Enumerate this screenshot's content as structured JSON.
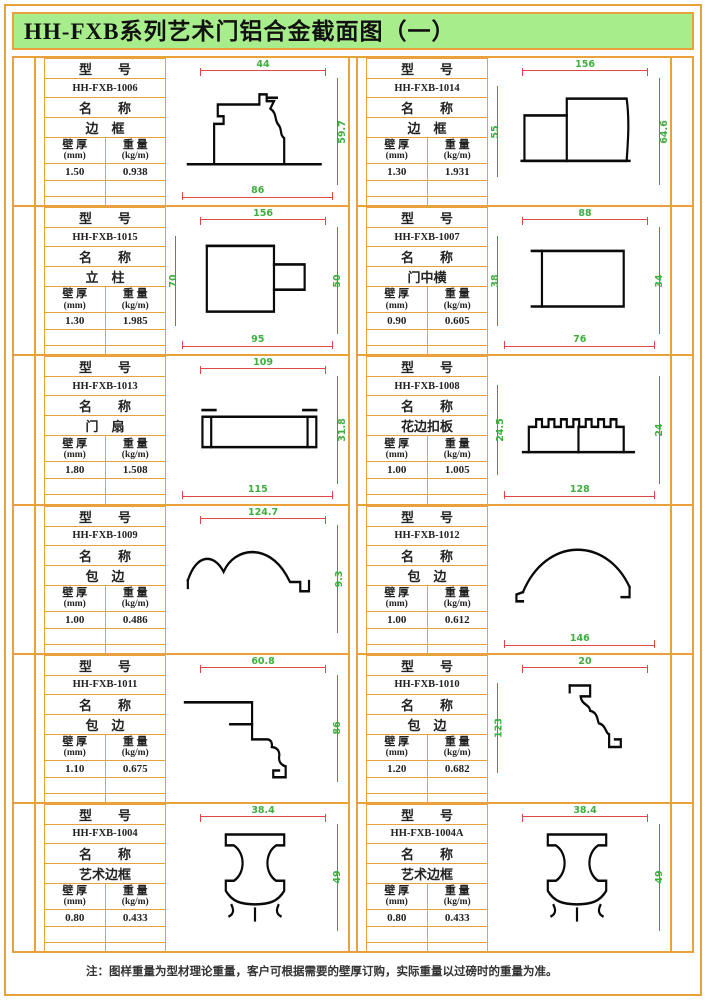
{
  "title": "HH-FXB系列艺术门铝合金截面图（一）",
  "footer_note": "注：图样重量为型材理论重量，客户可根据需要的壁厚订购，实际重量以过磅时的重量为准。",
  "colors": {
    "accent_orange": "#E8A13B",
    "header_green": "#A8ED8C",
    "dimension_line_red": "#E04848",
    "dimension_text_green": "#3FAE3F"
  },
  "labels": {
    "model": "型　　号",
    "name": "名　　称",
    "thickness_cn": "壁 厚",
    "thickness_unit": "(mm)",
    "weight_cn": "重 量",
    "weight_unit": "(kg/m)"
  },
  "panels": [
    {
      "model": "HH-FXB-1006",
      "name": "边　框",
      "thickness": "1.50",
      "weight": "0.938",
      "shape": "stepped-frame",
      "dims": {
        "top": "44",
        "right": "59.7",
        "bottom": "86"
      }
    },
    {
      "model": "HH-FXB-1014",
      "name": "边　框",
      "thickness": "1.30",
      "weight": "1.931",
      "shape": "double-box",
      "dims": {
        "top": "156",
        "left": "55",
        "right": "64.6"
      }
    },
    {
      "model": "HH-FXB-1015",
      "name": "立　柱",
      "thickness": "1.30",
      "weight": "1.985",
      "shape": "box-with-tab",
      "dims": {
        "top": "156",
        "left": "70",
        "right": "50",
        "bottom": "95"
      }
    },
    {
      "model": "HH-FXB-1007",
      "name": "门中横",
      "thickness": "0.90",
      "weight": "0.605",
      "shape": "hollow-box",
      "dims": {
        "top": "88",
        "left": "38",
        "right": "34",
        "bottom": "76"
      }
    },
    {
      "model": "HH-FXB-1013",
      "name": "门　扇",
      "thickness": "1.80",
      "weight": "1.508",
      "shape": "flat-panel",
      "dims": {
        "top": "109",
        "right": "31.8",
        "bottom": "115"
      }
    },
    {
      "model": "HH-FXB-1008",
      "name": "花边扣板",
      "thickness": "1.00",
      "weight": "1.005",
      "shape": "serrated-panel",
      "dims": {
        "left": "24.5",
        "right": "24",
        "bottom": "128"
      }
    },
    {
      "model": "HH-FXB-1009",
      "name": "包　边",
      "thickness": "1.00",
      "weight": "0.486",
      "shape": "double-arc",
      "dims": {
        "top": "124.7",
        "right": "9.3"
      }
    },
    {
      "model": "HH-FXB-1012",
      "name": "包　边",
      "thickness": "1.00",
      "weight": "0.612",
      "shape": "arch",
      "dims": {
        "bottom": "146"
      }
    },
    {
      "model": "HH-FXB-1011",
      "name": "包　边",
      "thickness": "1.10",
      "weight": "0.675",
      "shape": "cornice-left",
      "dims": {
        "top": "60.8",
        "right": "86"
      }
    },
    {
      "model": "HH-FXB-1010",
      "name": "包　边",
      "thickness": "1.20",
      "weight": "0.682",
      "shape": "cornice-right",
      "dims": {
        "top": "20",
        "left": "123"
      }
    },
    {
      "model": "HH-FXB-1004",
      "name": "艺术边框",
      "thickness": "0.80",
      "weight": "0.433",
      "shape": "art-hourglass",
      "dims": {
        "top": "38.4",
        "right": "49"
      }
    },
    {
      "model": "HH-FXB-1004A",
      "name": "艺术边框",
      "thickness": "0.80",
      "weight": "0.433",
      "shape": "art-hourglass",
      "dims": {
        "top": "38.4",
        "right": "49"
      }
    }
  ]
}
